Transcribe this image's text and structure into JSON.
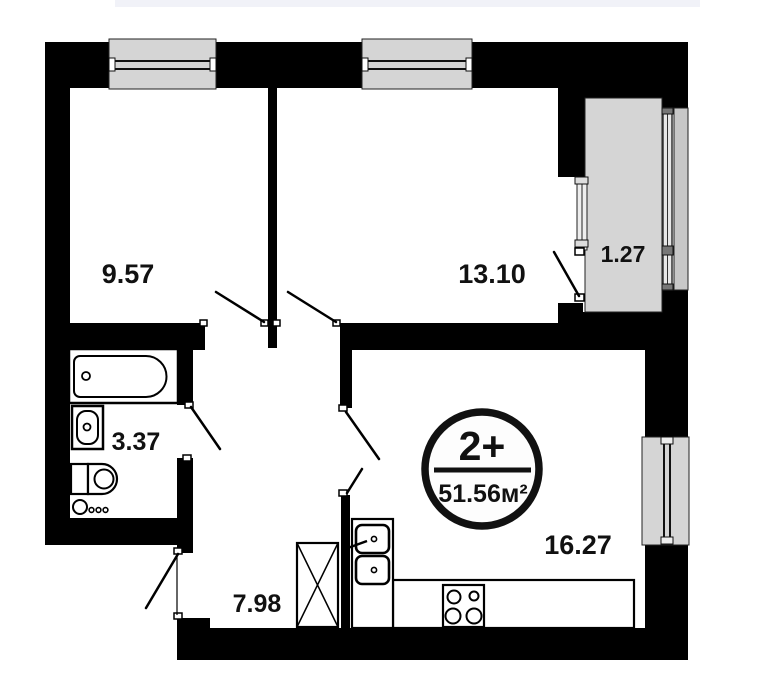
{
  "page": {
    "background_color": "#ffffff",
    "top_strip_color": "#f1f2f8"
  },
  "plan": {
    "badge": {
      "type_label": "2+",
      "area_label": "51.56м²"
    },
    "rooms": [
      {
        "name": "bedroom-left",
        "area": "9.57"
      },
      {
        "name": "bedroom-right",
        "area": "13.10"
      },
      {
        "name": "balcony",
        "area": "1.27"
      },
      {
        "name": "bathroom",
        "area": "3.37"
      },
      {
        "name": "kitchen-living",
        "area": "16.27"
      },
      {
        "name": "hallway",
        "area": "7.98"
      }
    ],
    "fixtures": [
      "bathtub-icon",
      "washbasin-icon",
      "toilet-icon",
      "washing-machine-icon",
      "wardrobe-icon",
      "kitchen-sink-icon",
      "stove-icon",
      "counter",
      "window",
      "door-swing"
    ],
    "colors": {
      "wall": "#000000",
      "window_gray": "#d5d5d5",
      "panel_gray": "#c8c8c8",
      "text": "#111111"
    }
  }
}
